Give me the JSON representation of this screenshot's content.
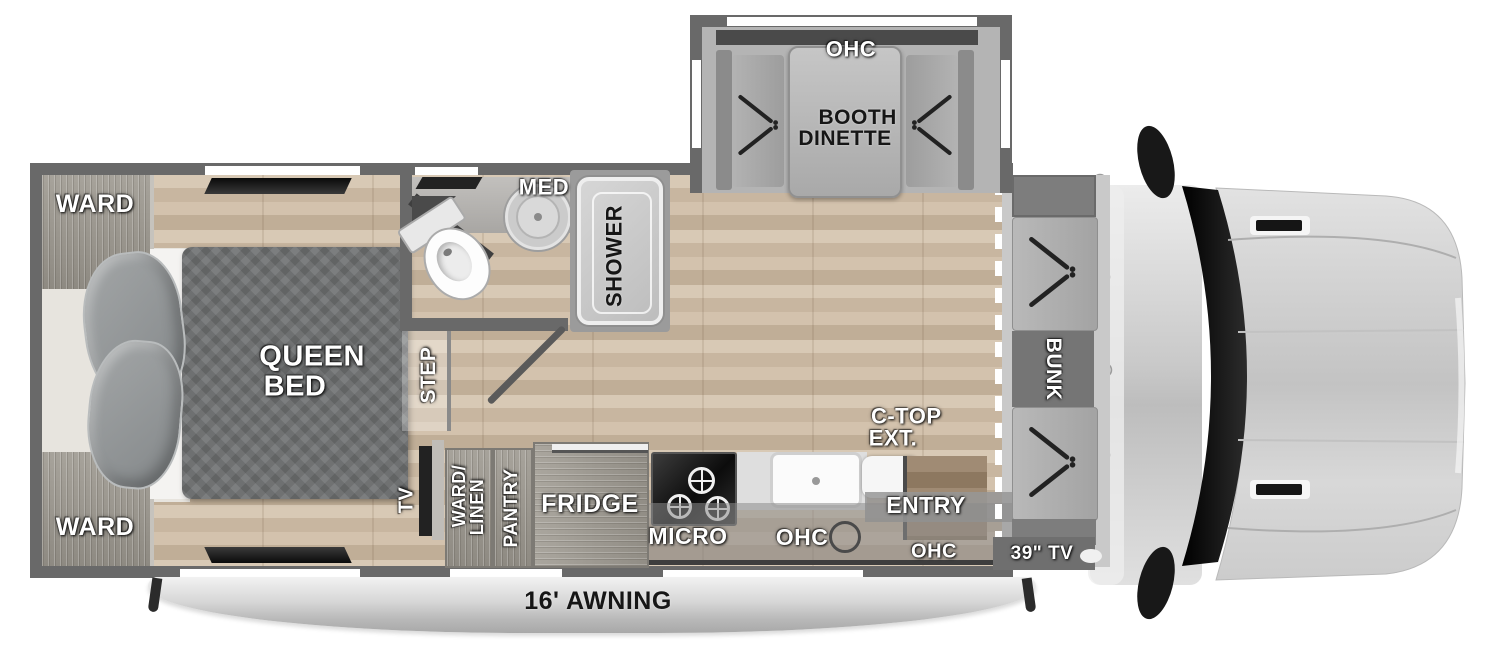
{
  "labels": {
    "dinette_ohc": "OHC",
    "dinette_line1": "BOOTH",
    "dinette_line2": "DINETTE",
    "ward_top": "WARD",
    "ward_bottom": "WARD",
    "queen_line1": "QUEEN",
    "queen_line2": "BED",
    "med": "MED",
    "shower": "SHOWER",
    "step": "STEP",
    "tv": "TV",
    "ward_linen_line1": "WARD/",
    "ward_linen_line2": "LINEN",
    "pantry": "PANTRY",
    "fridge": "FRIDGE",
    "micro": "MICRO",
    "ohc_kitchen": "OHC",
    "ctop_line1": "C-TOP",
    "ctop_line2": "EXT.",
    "entry": "ENTRY",
    "ohc_entry": "OHC",
    "tv_39": "39\" TV",
    "bunk": "BUNK",
    "awning": "16' AWNING"
  },
  "colors": {
    "wall": "#696969",
    "floor_wood": "#cfbfa9",
    "mattress": "#6d6f70",
    "slide_interior": "#b4b4b4",
    "cab_glass": "#111111",
    "label_white": "#ffffff",
    "label_dark": "#161616",
    "awning_silver": "#c9c9c9"
  }
}
